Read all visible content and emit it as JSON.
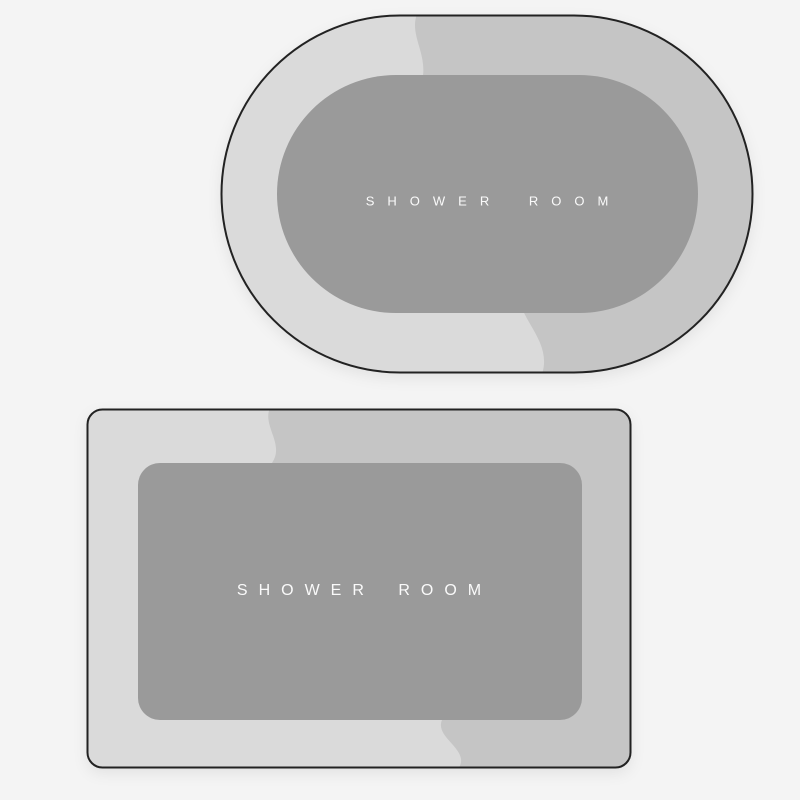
{
  "image": {
    "background_color": "#f4f4f4"
  },
  "colors": {
    "mat_outline": "#222222",
    "mat_ring_light": "#dadada",
    "mat_ring_dark": "#c5c5c5",
    "mat_center": "#9a9a9a",
    "label_text": "#fafafa"
  },
  "mats": [
    {
      "shape": "oval",
      "label": "SHOWER ROOM"
    },
    {
      "shape": "rectangle",
      "label": "SHOWER ROOM"
    }
  ]
}
